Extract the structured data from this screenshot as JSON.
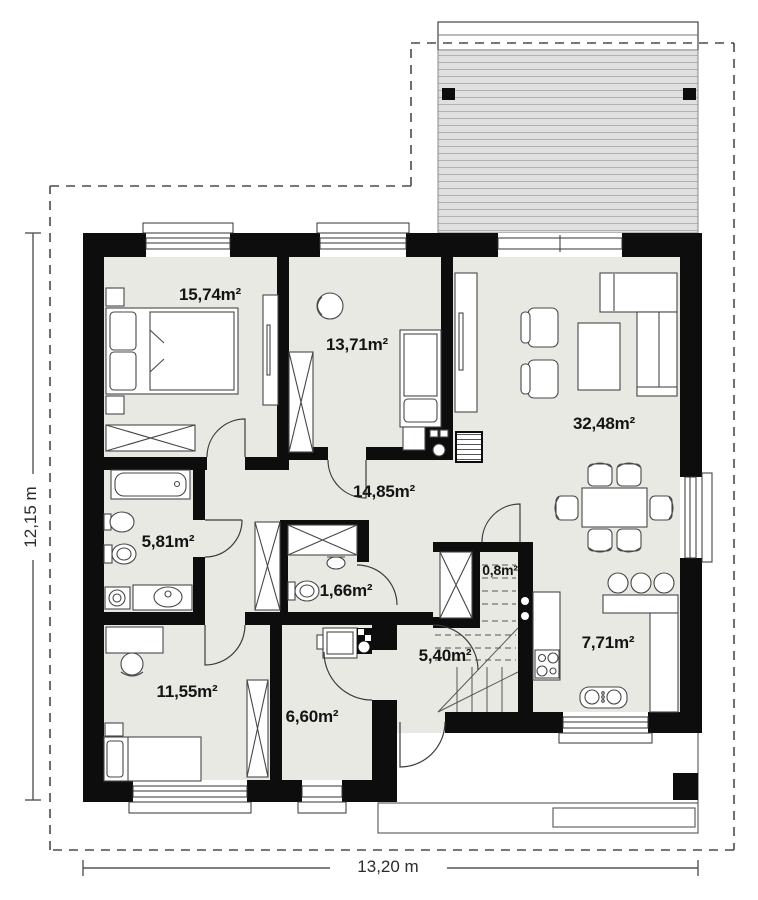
{
  "floor_plan": {
    "rooms": [
      {
        "name": "bedroom-large",
        "area_label": "15,74m²"
      },
      {
        "name": "room-middle",
        "area_label": "13,71m²"
      },
      {
        "name": "living-room",
        "area_label": "32,48m²"
      },
      {
        "name": "hallway",
        "area_label": "14,85m²"
      },
      {
        "name": "bathroom",
        "area_label": "5,81m²"
      },
      {
        "name": "wc",
        "area_label": "1,66m²"
      },
      {
        "name": "under-stair-closet",
        "area_label": "0,8m²"
      },
      {
        "name": "bedroom-small",
        "area_label": "11,55m²"
      },
      {
        "name": "entry-hall",
        "area_label": "5,40m²"
      },
      {
        "name": "utility-room",
        "area_label": "6,60m²"
      },
      {
        "name": "kitchen",
        "area_label": "7,71m²"
      }
    ],
    "dimensions": {
      "total_width": "13,20 m",
      "total_height": "12,15 m"
    },
    "colors": {
      "wall": "#0d0d0d",
      "room_fill": "#e9e9e4",
      "terrace_fill": "#e0e0e0",
      "terrace_stripe": "#b2b2b2",
      "line": "#555555"
    }
  }
}
